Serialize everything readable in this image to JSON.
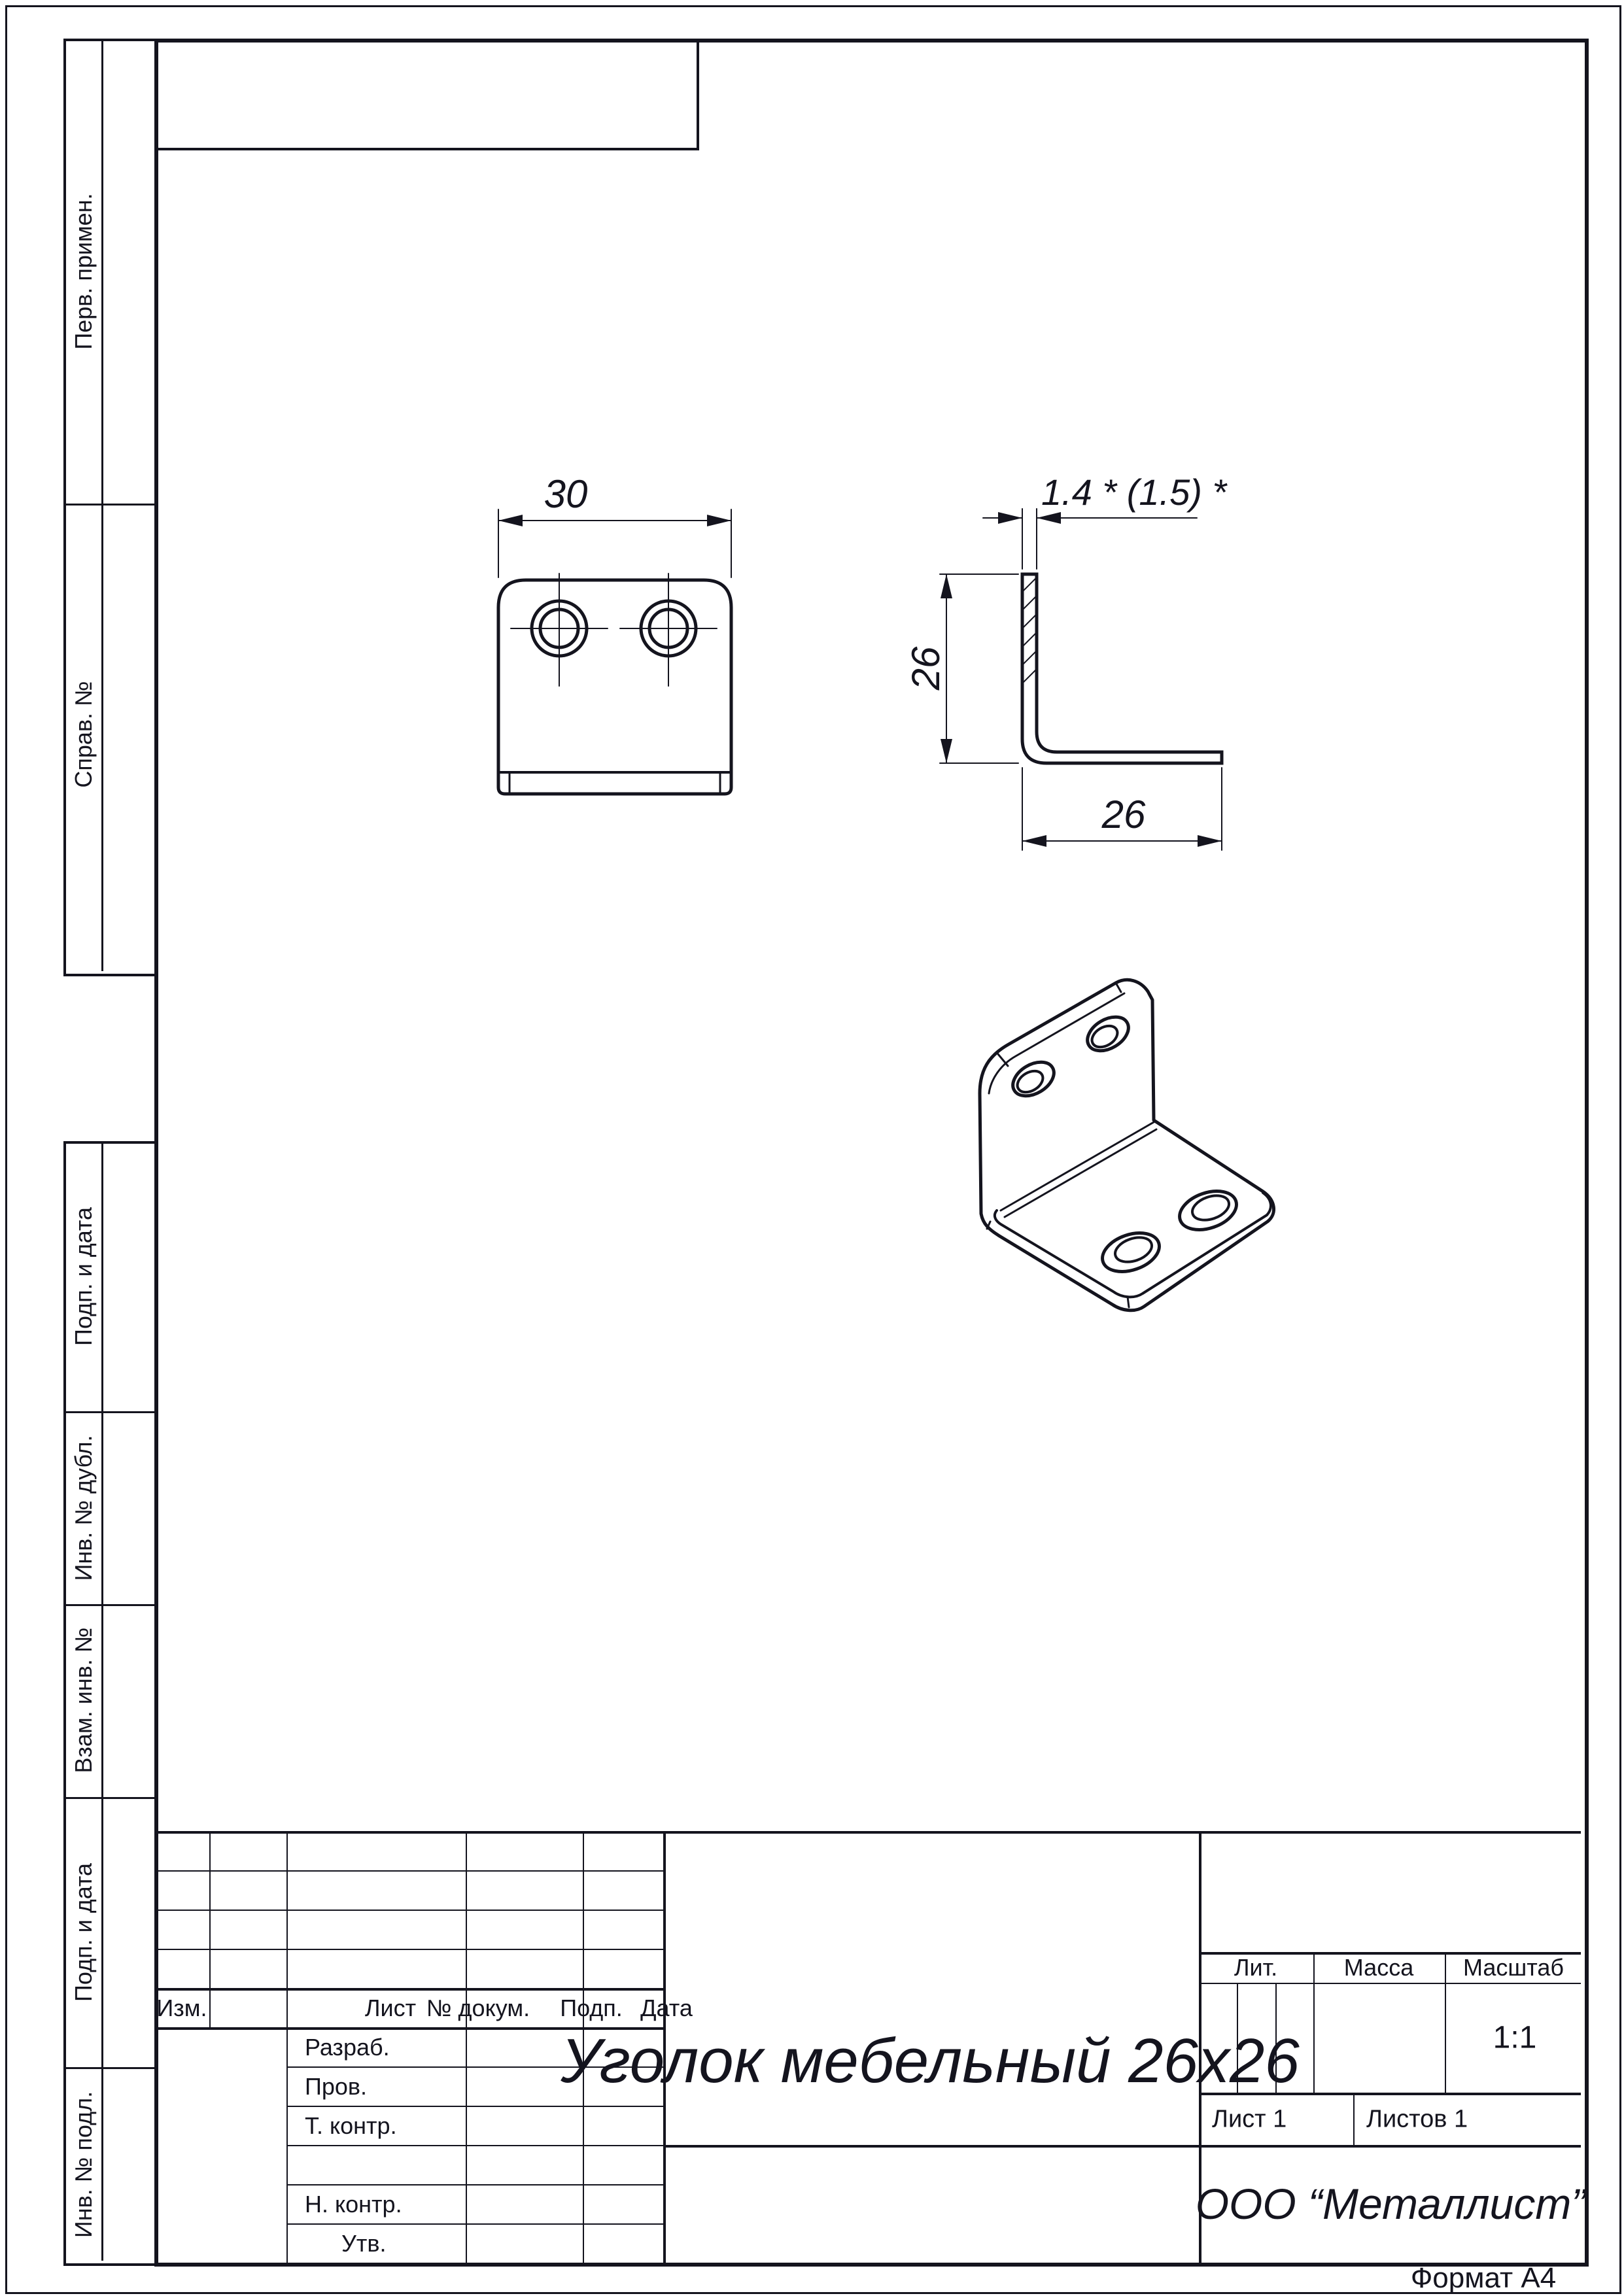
{
  "page": {
    "format_note": "Формат А4"
  },
  "margin_labels": [
    "Перв. примен.",
    "Справ. №",
    "Подп. и дата",
    "Инв. № дубл.",
    "Взам. инв. №",
    "Подп. и дата",
    "Инв. № подл."
  ],
  "views": {
    "front": {
      "width": "30"
    },
    "side": {
      "thickness": "1.4 *  (1.5) *",
      "height": "26",
      "depth": "26"
    }
  },
  "title_block": {
    "header": [
      "Изм.",
      "Лист",
      "№ докум.",
      "Подп.",
      "Дата"
    ],
    "staff": [
      "Разраб.",
      "Пров.",
      "Т. контр.",
      "Н. контр.",
      "Утв."
    ],
    "name": "Уголок мебельный 26х26",
    "lit_label": "Лит.",
    "mass_label": "Масса",
    "scale_label": "Масштаб",
    "scale_value": "1:1",
    "sheet_info": "Лист 1",
    "sheets_info": "Листов 1",
    "company": "ООО  “Металлист”"
  }
}
